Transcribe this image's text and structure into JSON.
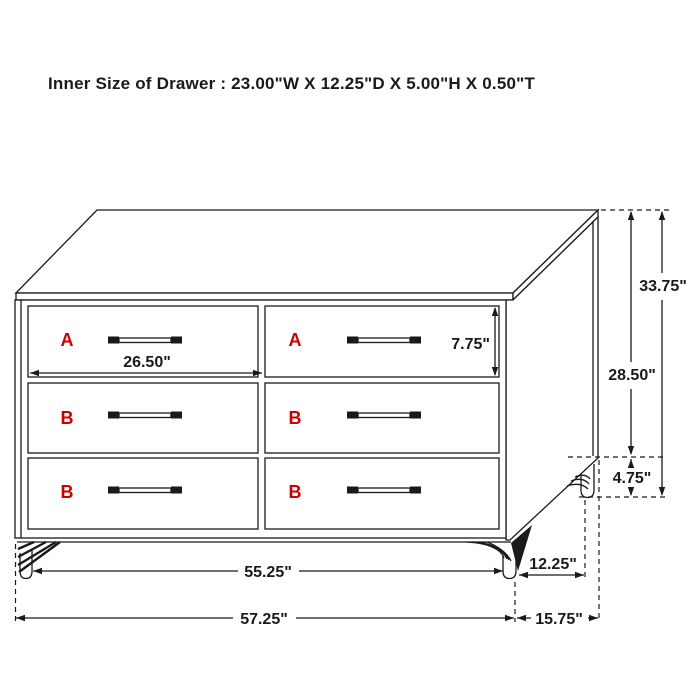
{
  "title": "Inner Size of Drawer : 23.00\"W X 12.25\"D X 5.00\"H X 0.50\"T",
  "colors": {
    "line": "#1a1a1a",
    "drawer_label": "#cc0000",
    "background": "#ffffff"
  },
  "drawers": {
    "labels": [
      "A",
      "A",
      "B",
      "B",
      "B",
      "B"
    ]
  },
  "dimensions": {
    "drawer_face_width": "26.50\"",
    "drawer_face_height": "7.75\"",
    "overall_height": "33.75\"",
    "case_height": "28.50\"",
    "leg_height": "4.75\"",
    "leg_span_width": "55.25\"",
    "overall_width": "57.25\"",
    "leg_span_depth": "12.25\"",
    "overall_depth": "15.75\""
  }
}
